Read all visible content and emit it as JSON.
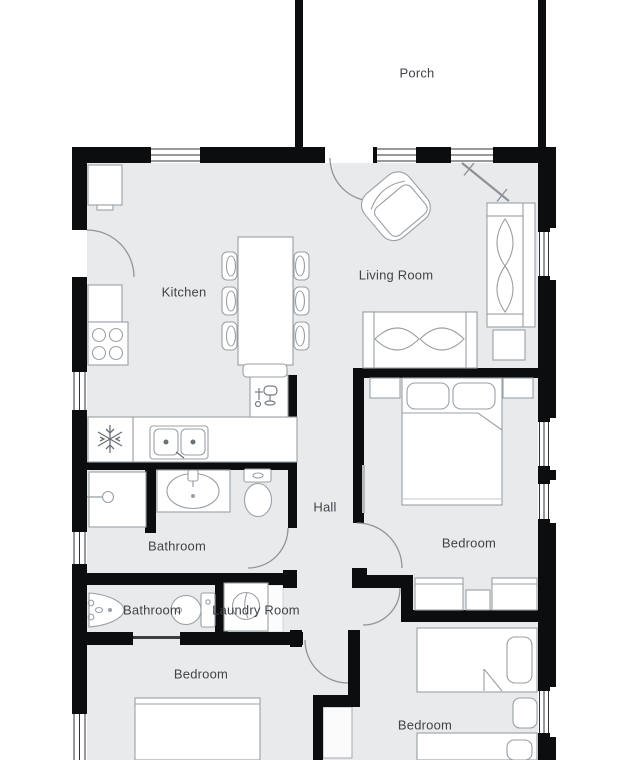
{
  "rooms": {
    "porch": {
      "label": "Porch"
    },
    "kitchen": {
      "label": "Kitchen"
    },
    "living_room": {
      "label": "Living Room"
    },
    "hall": {
      "label": "Hall"
    },
    "bathroom_main": {
      "label": "Bathroom"
    },
    "bedroom_right": {
      "label": "Bedroom"
    },
    "bathroom_small": {
      "label": "Bathroom"
    },
    "laundry_room": {
      "label": "Laundry Room"
    },
    "bedroom_left": {
      "label": "Bedroom"
    },
    "bedroom_bottom": {
      "label": "Bedroom"
    }
  },
  "fixtures": [
    "refrigerator-icon",
    "stove-icon",
    "kitchen-sink-icon",
    "dishwasher-icon",
    "kitchen-island",
    "dining-chairs",
    "cabinet",
    "shower",
    "vanity-sink",
    "toilet",
    "wall-sink",
    "washing-machine",
    "double-bed",
    "nightstand",
    "wardrobe",
    "single-bed",
    "sofa",
    "loveseat",
    "armchair",
    "side-table",
    "closet",
    "wall-mirror"
  ],
  "colors": {
    "background": "#ffffff",
    "floor": "#e9eaeb",
    "wall": "#0c0d0e",
    "furniture_fill": "#ffffff",
    "furniture_stroke": "#9aa0a5",
    "label_text": "#3f4449"
  }
}
